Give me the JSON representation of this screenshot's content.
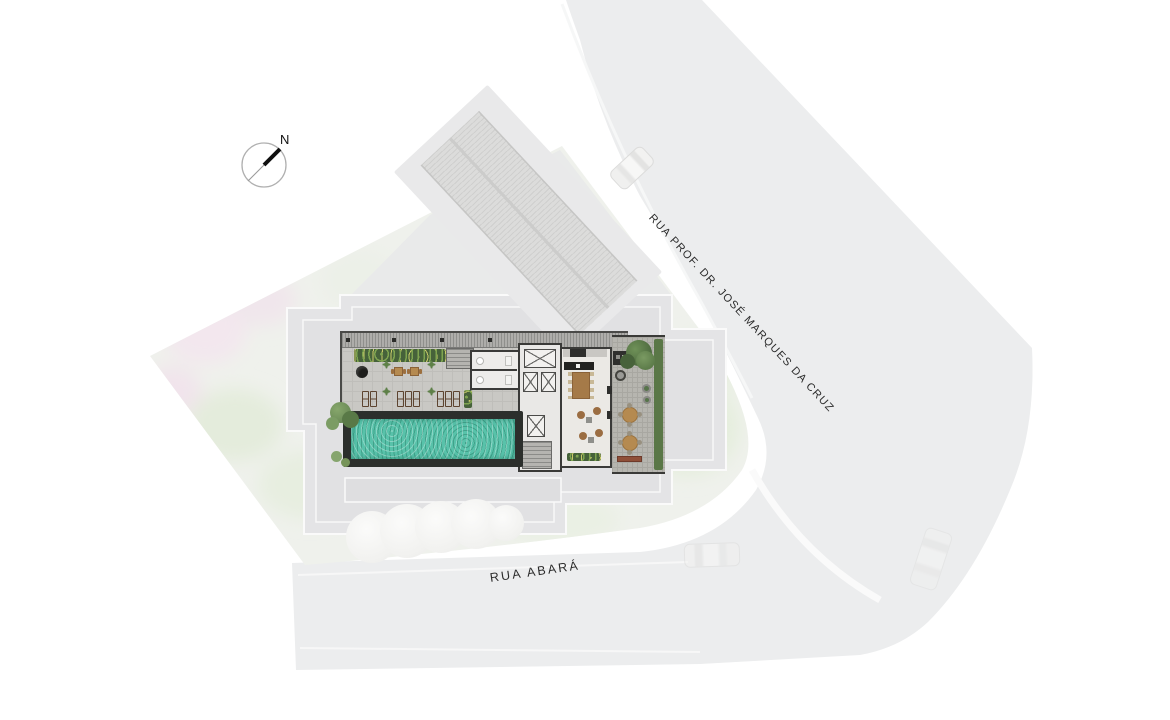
{
  "compass": {
    "label": "N"
  },
  "streets": {
    "main_label": "RUA PROF. DR. JOSÉ MARQUES DA CRUZ",
    "south_label": "RUA ABARÁ"
  },
  "colors": {
    "page-bg": "#ffffff",
    "street": "#ecedee",
    "garden-green": "#e9efe4",
    "garden-pink": "#f3e7ee",
    "footprint": "#e4e4e6",
    "deck": "#c9c8c4",
    "terrace": "#b6b5af",
    "wall": "#3a3a38",
    "pool-water": "#58c2aa",
    "pool-deck": "#2c2f2c",
    "lounger": "#7d5c3e",
    "planter": "#46623a",
    "tree": "#52714a",
    "table-tan": "#b58a50",
    "bench": "#8f4f38",
    "label-ink": "#2b2b2b"
  }
}
